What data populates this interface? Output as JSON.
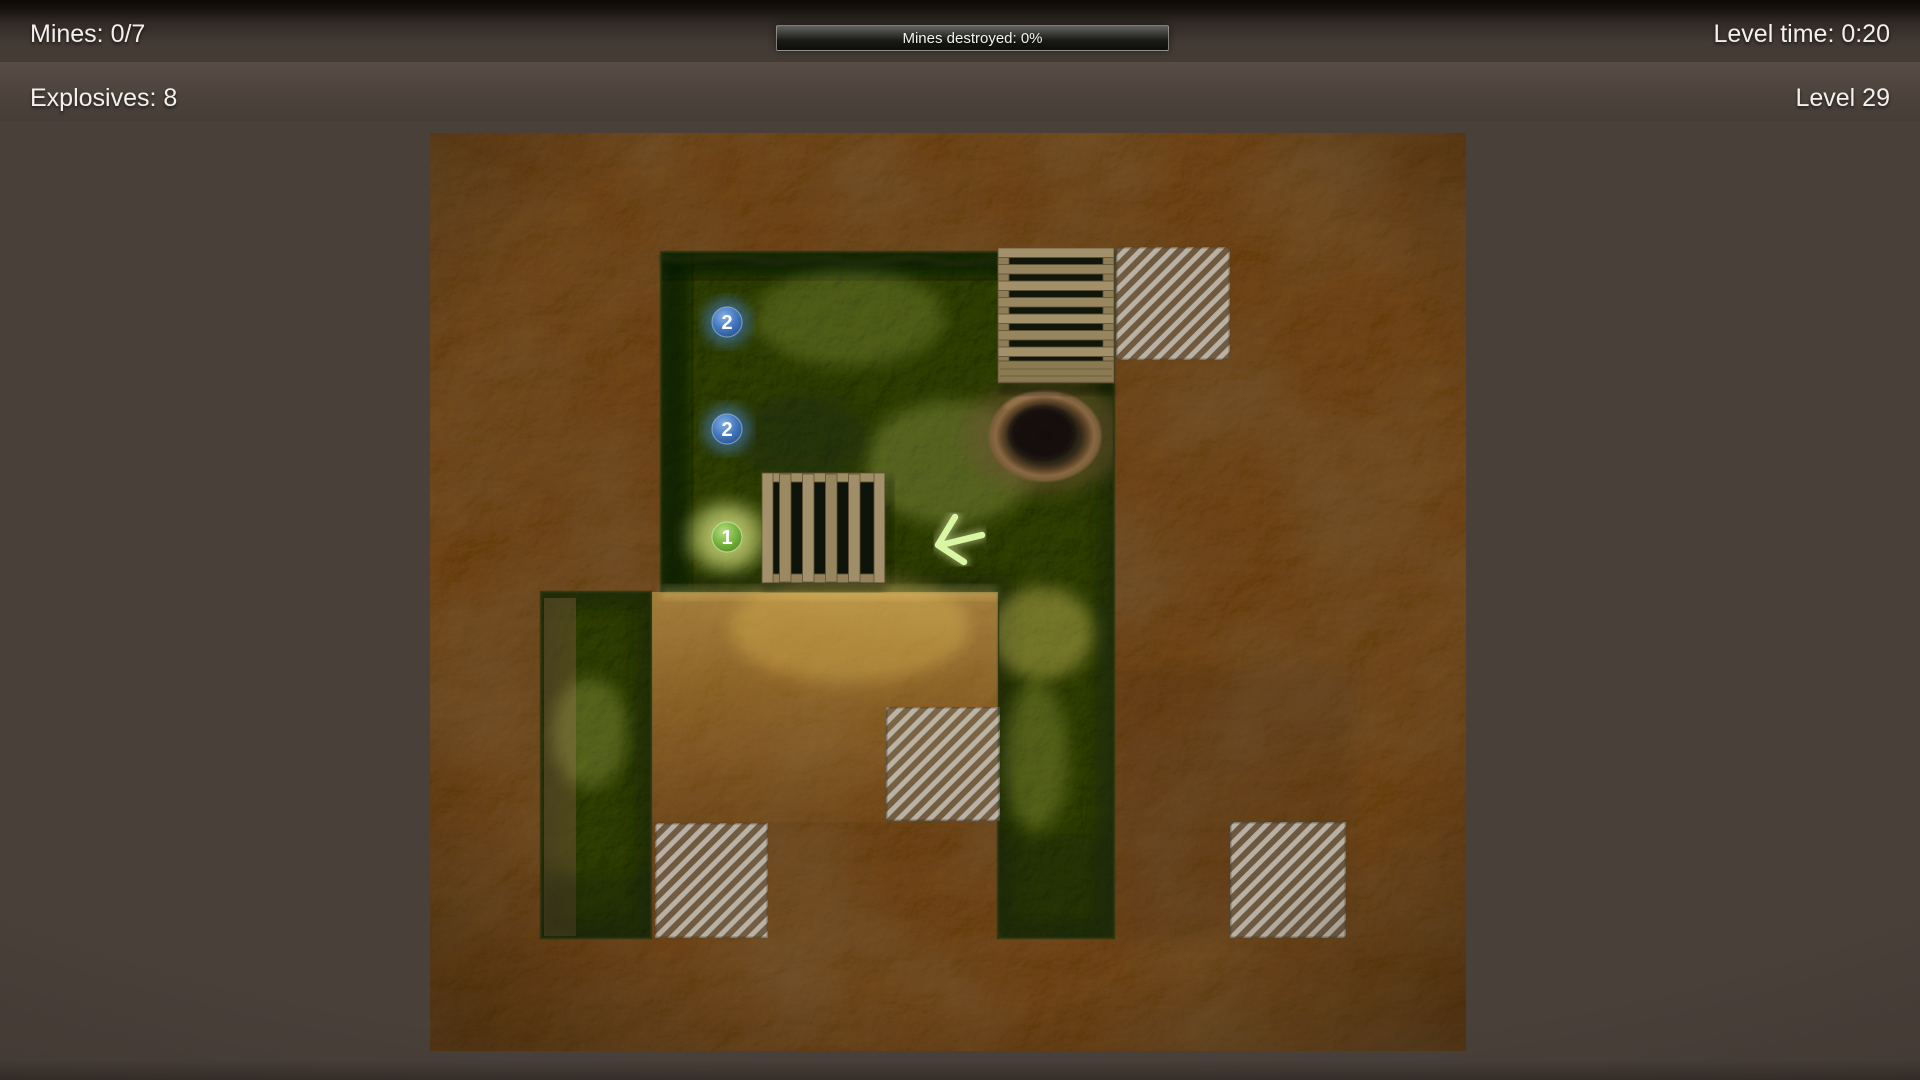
{
  "hud": {
    "mines": "Mines: 0/7",
    "progress": "Mines destroyed: 0%",
    "level_time": "Level time: 0:20",
    "explosives": "Explosives: 8",
    "level": "Level 29"
  },
  "board": {
    "hints": [
      "2",
      "2",
      "1"
    ]
  },
  "colors": {
    "badge_blue": "#3f74bc",
    "badge_green": "#77b741",
    "arrow": "#d9f7a2",
    "plate_stripe": "#cdc9bf",
    "grass": "#49571f",
    "dirt": "#8a6b40"
  }
}
